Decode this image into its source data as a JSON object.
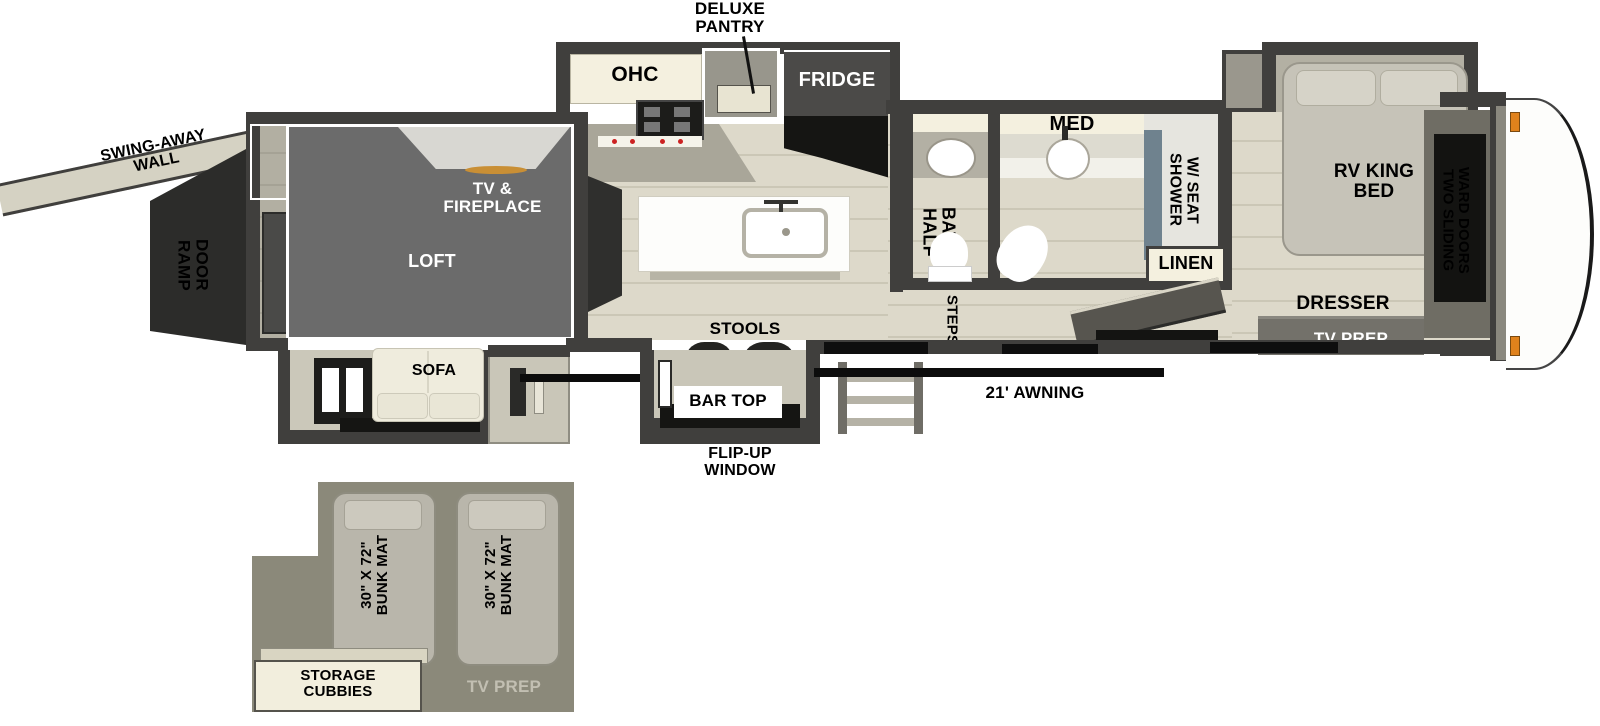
{
  "floorplan": {
    "title_hint": "RV toy hauler fifth-wheel floor plan",
    "exterior": {
      "swing_away_wall": "SWING-AWAY\nWALL",
      "ramp_door": "RAMP\nDOOR",
      "awning": "21' AWNING",
      "flip_up_window": "FLIP-UP\nWINDOW"
    },
    "garage": {
      "fold_up_steps": "FOLD-UP\nSTEPS",
      "tv_fireplace": "TV &\nFIREPLACE",
      "loft": "LOFT",
      "sofa": "SOFA"
    },
    "kitchen": {
      "deluxe_pantry": "DELUXE\nPANTRY",
      "ohc": "OHC",
      "fridge": "FRIDGE",
      "stools": "STOOLS",
      "bar_top": "BAR TOP"
    },
    "bathroom": {
      "med": "MED",
      "half_bath": "HALF\nBATH",
      "shower": "SHOWER\nW/ SEAT",
      "linen": "LINEN",
      "steps": "STEPS"
    },
    "bedroom": {
      "rv_king_bed": "RV KING\nBED",
      "ward_doors": "TWO SLIDING\nWARD DOORS",
      "dresser": "DRESSER",
      "tv_prep": "TV PREP"
    },
    "loft_inset": {
      "bunk_mat_1": "30\" X 72\"\nBUNK MAT",
      "bunk_mat_2": "30\" X 72\"\nBUNK MAT",
      "storage_cubbies": "STORAGE\nCUBBIES",
      "tv_prep": "TV PREP"
    },
    "colors": {
      "wall": "#403f3d",
      "floor": "#ddd9ca",
      "cream": "#f4f0df",
      "loft_gray": "#6b6b6b",
      "olive_inset": "#8b897a",
      "marker_orange": "#e0821c",
      "fireplace_amber": "#c98f35"
    }
  }
}
